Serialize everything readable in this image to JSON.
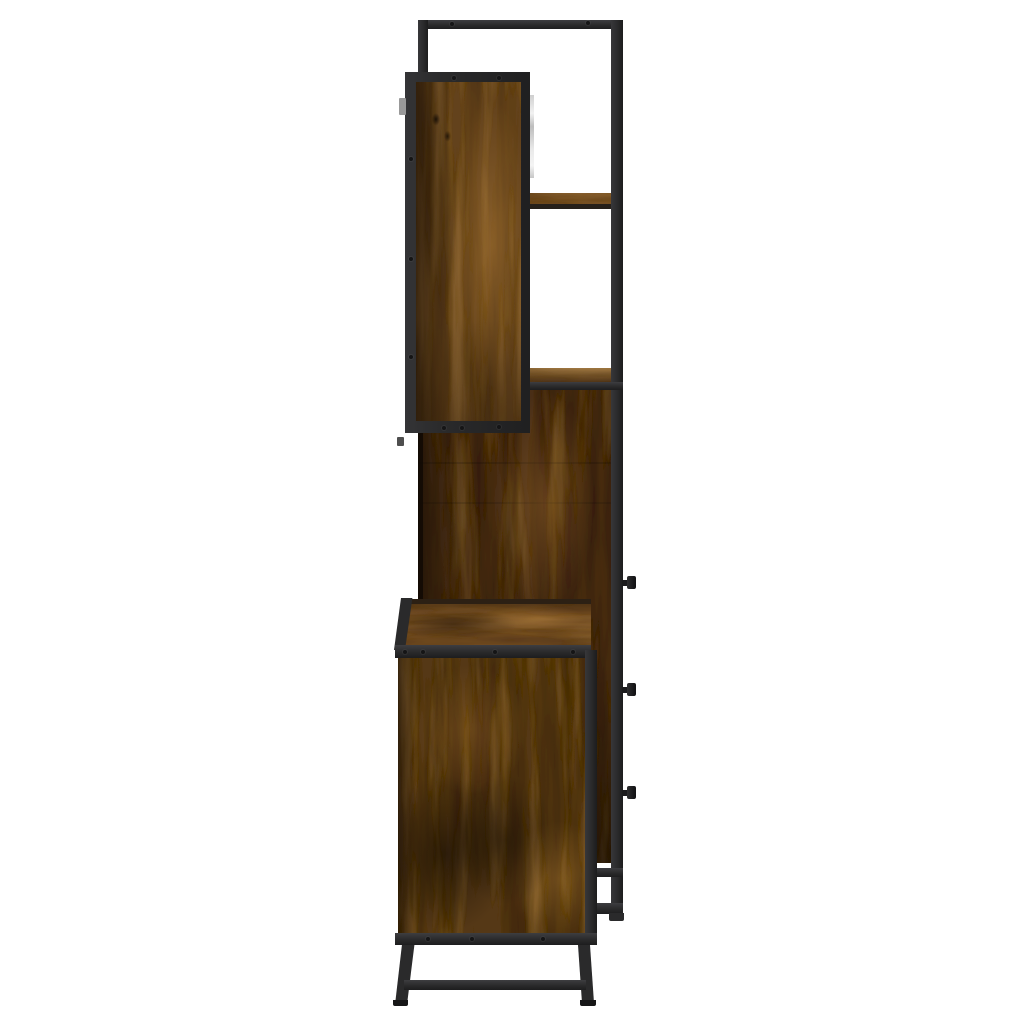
{
  "image": {
    "description": "Side view product photo of a three-piece bathroom furniture set in smoked oak engineered wood with black metal frames: wall cabinet top left, tall cabinet with three drawer knobs on the right, and a washbasin cabinet with splayed metal legs at the bottom, on a plain white background."
  },
  "colors": {
    "background": "#ffffff",
    "metal_frame": "#2a2a2b",
    "metal_highlight": "#3d3d40",
    "metal_dark": "#151516",
    "wood_wall_cabinet": "#64421e",
    "wood_tall_cabinet": "#4a2f13",
    "wood_washbasin_cabinet": "#553717",
    "wood_top_surfaces": "#6e4a20",
    "wood_grain_dark": "#120a03",
    "wood_grain_light": "#c0904c",
    "hinge_strip": "#cfcfcf",
    "bracket_grey": "#999999"
  }
}
